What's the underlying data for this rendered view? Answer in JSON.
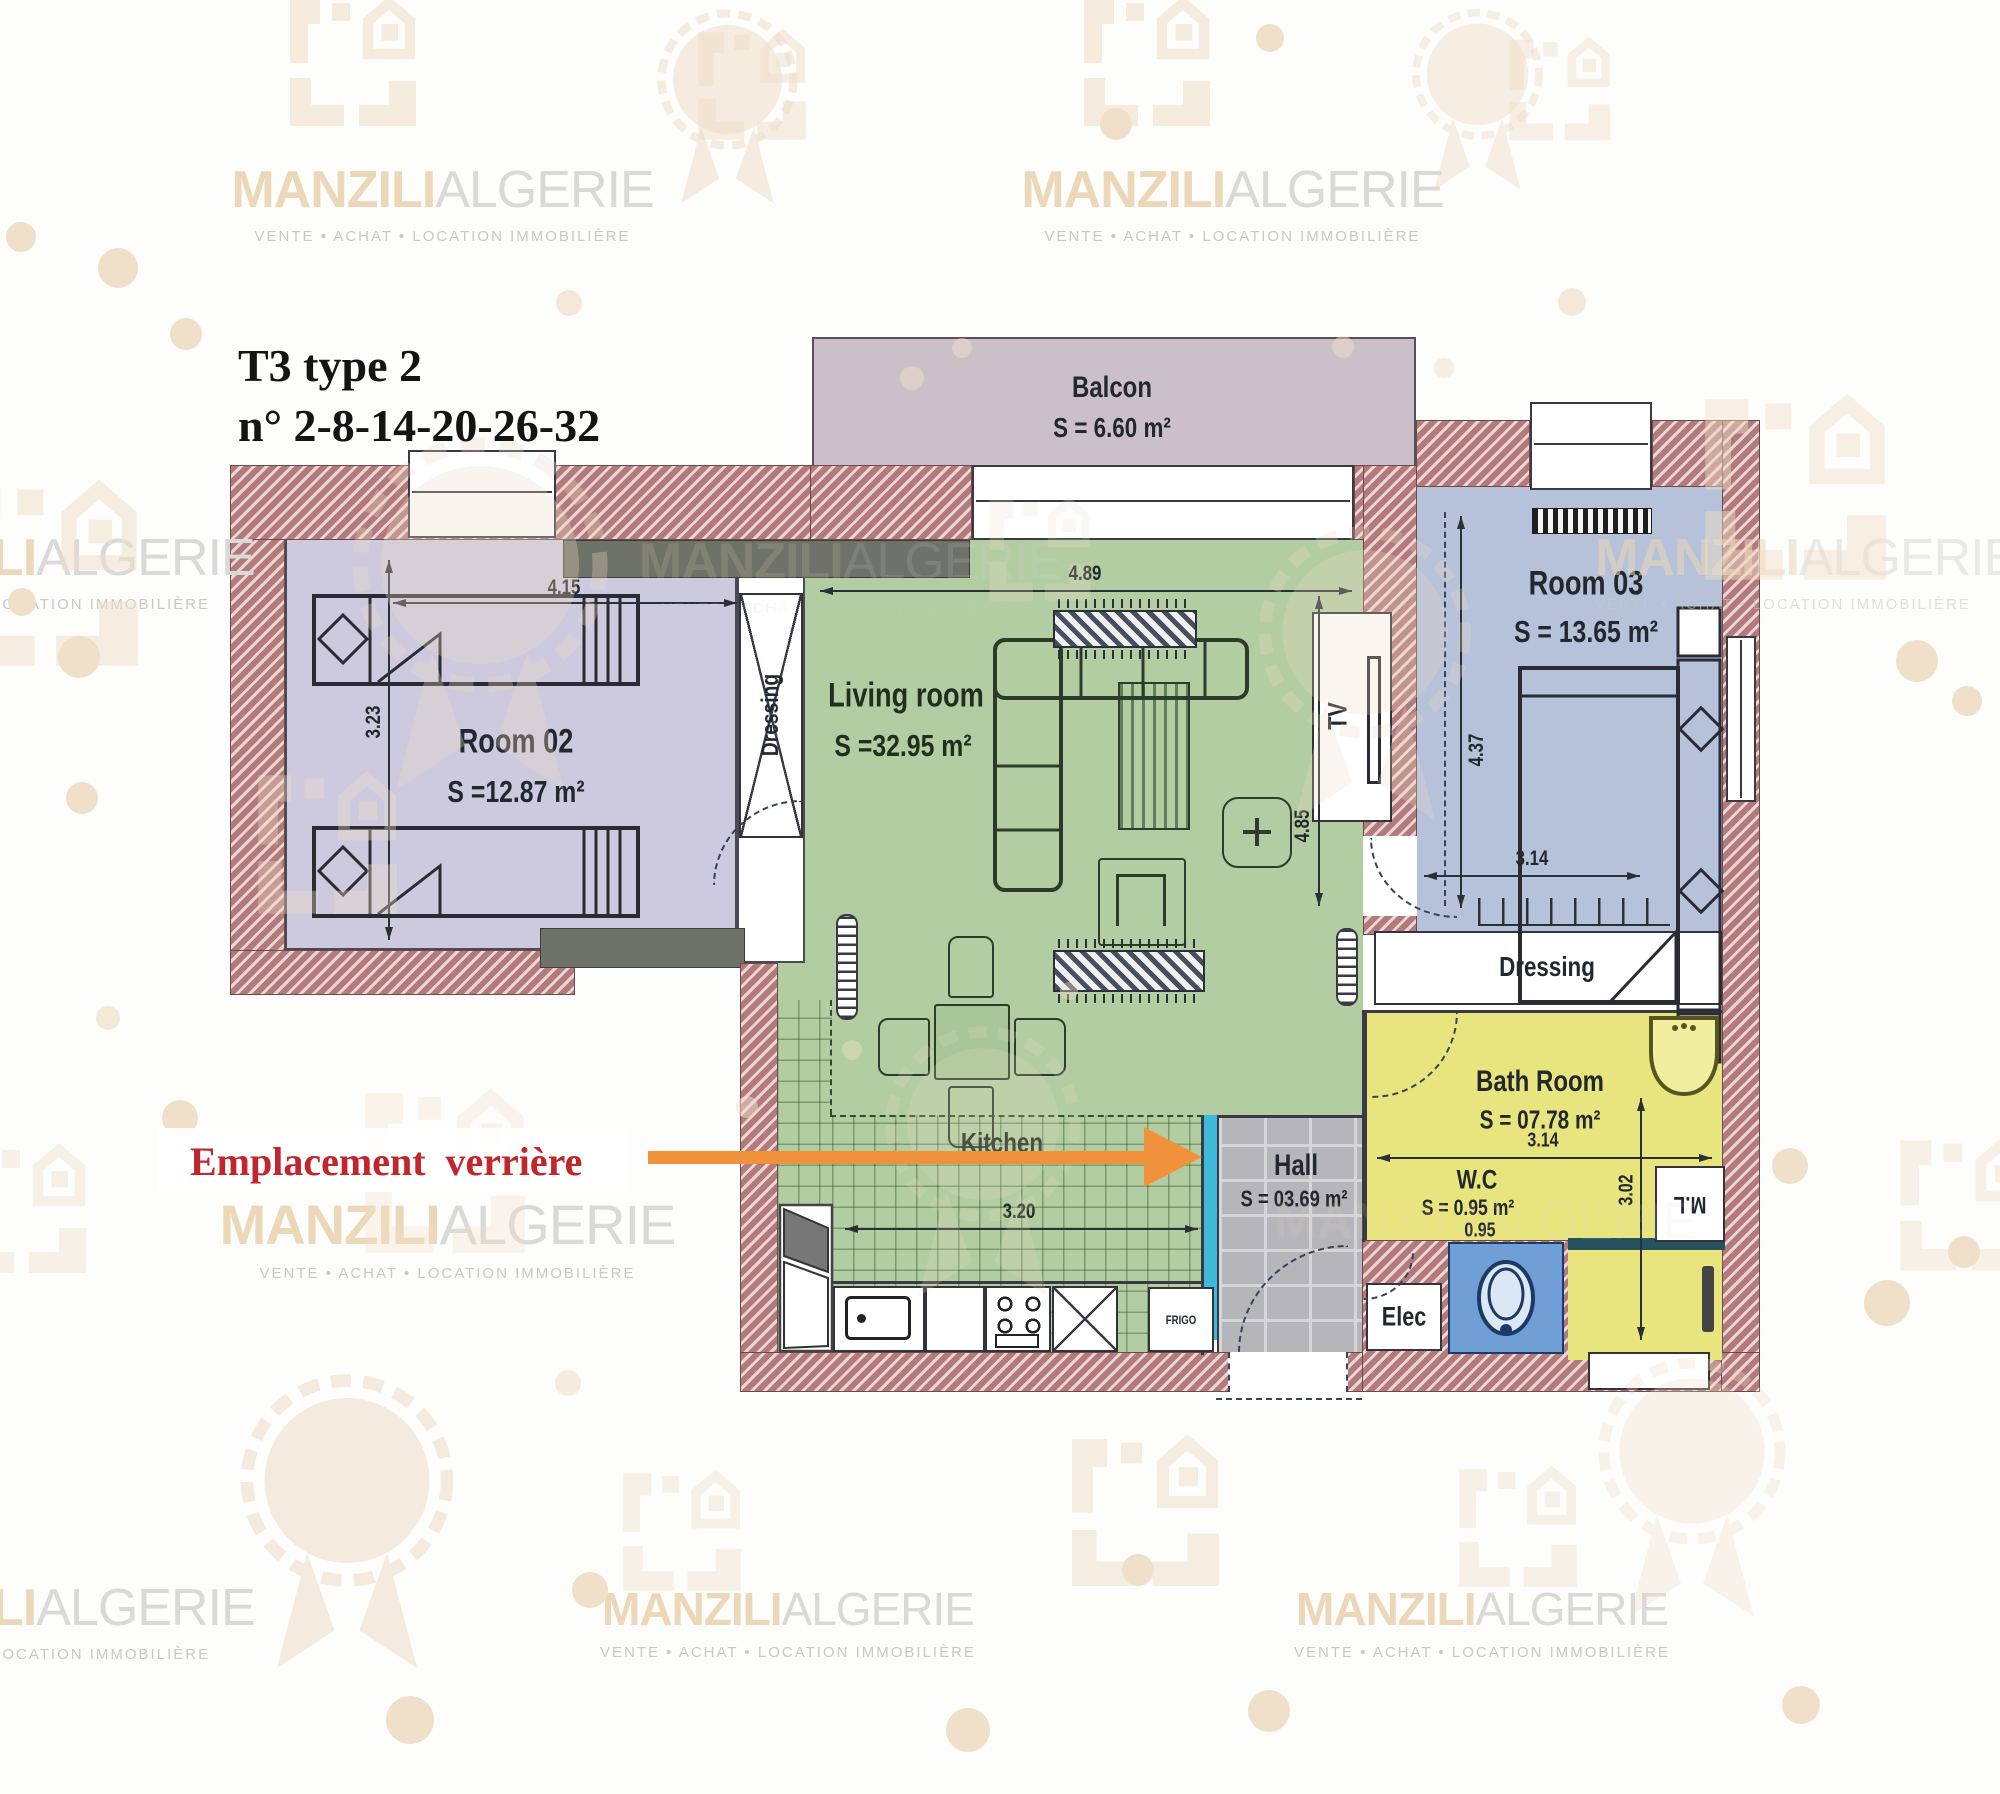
{
  "brand": {
    "bold": "MANZILI",
    "light": "ALGERIE",
    "partial_bold": "LI",
    "tagline": "VENTE • ACHAT • LOCATION IMMOBILIÈRE",
    "tagline_short": "LOCATION IMMOBILIÈRE"
  },
  "title": {
    "line1": "T3 type 2",
    "line2": "n° 2-8-14-20-26-32"
  },
  "annotation": {
    "label": "Emplacement verrière"
  },
  "rooms": {
    "balcony": {
      "name": "Balcon",
      "area": "S = 6.60 m²"
    },
    "room02": {
      "name": "Room 02",
      "area": "S =12.87 m²"
    },
    "living": {
      "name": "Living room",
      "area": "S =32.95 m²"
    },
    "room03": {
      "name": "Room 03",
      "area": "S = 13.65 m²"
    },
    "bath": {
      "name": "Bath Room",
      "area": "S = 07.78 m²"
    },
    "wc": {
      "name": "W.C",
      "area": "S = 0.95 m²"
    },
    "hall": {
      "name": "Hall",
      "area": "S = 03.69 m²"
    },
    "kitchen": {
      "name": "Kitchen"
    },
    "dressing1": {
      "name": "Dressing"
    },
    "dressing2": {
      "name": "Dressing"
    }
  },
  "fixtures": {
    "tv": "TV",
    "elec": "Elec",
    "ml": "M.L",
    "frigo": "FRIGO"
  },
  "dimensions": {
    "room02_w": "4.15",
    "room02_h": "3.23",
    "living_w": "4.89",
    "living_h": "4.85",
    "room03_h": "4.37",
    "room03_w": "3.14",
    "bath_w": "3.14",
    "wc_w": "0.95",
    "wc_h": "3.02",
    "kitchen_w": "3.20"
  },
  "colors": {
    "wall": "#b3797b",
    "balcony": "#cbc0c7",
    "room02": "#cdcadf",
    "living": "#b3cda3",
    "room03": "#b6c2d9",
    "bath": "#e9e57e",
    "hall": "#b5b5ba",
    "toilet_box": "#6f9fd4",
    "verriere": "#3fb9dc",
    "arrow": "#f0913c",
    "annotation_text": "#c0262c",
    "watermark": "#eedcc4"
  }
}
